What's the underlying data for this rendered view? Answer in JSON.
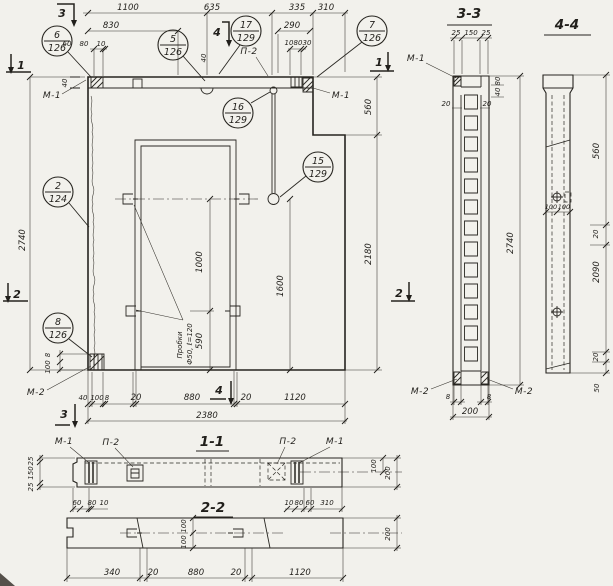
{
  "callouts": [
    {
      "num": "6",
      "sheet": "126"
    },
    {
      "num": "5",
      "sheet": "126"
    },
    {
      "num": "17",
      "sheet": "129"
    },
    {
      "num": "7",
      "sheet": "126"
    },
    {
      "num": "16",
      "sheet": "129"
    },
    {
      "num": "15",
      "sheet": "129"
    },
    {
      "num": "2",
      "sheet": "124"
    },
    {
      "num": "8",
      "sheet": "126"
    }
  ],
  "labels": {
    "m1": "М-1",
    "m2": "М-2",
    "p2": "П-2"
  },
  "markers": {
    "s1": "1",
    "s2": "2",
    "s3": "3",
    "s4": "4"
  },
  "main": {
    "top_dims": [
      "1100",
      "635",
      "335",
      "310"
    ],
    "dim_830": "830",
    "dim_290": "290",
    "embed_left_dims": [
      "60",
      "80",
      "10"
    ],
    "embed_right_dims": [
      "10",
      "80",
      "30"
    ],
    "thickness_left": "40",
    "thickness_mid": "40",
    "height": "2740",
    "notch_depth": "560",
    "right_height": "2180",
    "opening_half": "1000",
    "loop_height": "1600",
    "plug_height": "590",
    "note_line1": "Пробки",
    "note_line2": "Ф50, ℓ=120",
    "corner_dims": [
      "8",
      "100"
    ],
    "bottom_dims": [
      "40",
      "100",
      "8",
      "20",
      "880",
      "20",
      "1120"
    ],
    "width_total": "2380"
  },
  "section11": {
    "title": "1-1",
    "left_heights": [
      "25",
      "150",
      "25"
    ],
    "left_dims": [
      "60",
      "80",
      "10"
    ],
    "right_dims": [
      "10",
      "80",
      "60",
      "310"
    ],
    "right_heights": [
      "100",
      "200"
    ]
  },
  "section22": {
    "title": "2-2",
    "mid_heights": [
      "100",
      "100"
    ],
    "height": "200",
    "bottom_dims": [
      "340",
      "20",
      "880",
      "20",
      "1120"
    ]
  },
  "section33": {
    "title": "3-3",
    "top_dims": [
      "25",
      "150",
      "25"
    ],
    "depth_dims": [
      "80",
      "40"
    ],
    "wall_dims": [
      "20",
      "20"
    ],
    "height": "2740",
    "bottom_dims": [
      "8",
      "8"
    ],
    "width": "200"
  },
  "section44": {
    "title": "4-4",
    "hole_dims": [
      "100",
      "100"
    ],
    "right_dims": [
      "560",
      "20",
      "2090",
      "20",
      "50"
    ]
  }
}
